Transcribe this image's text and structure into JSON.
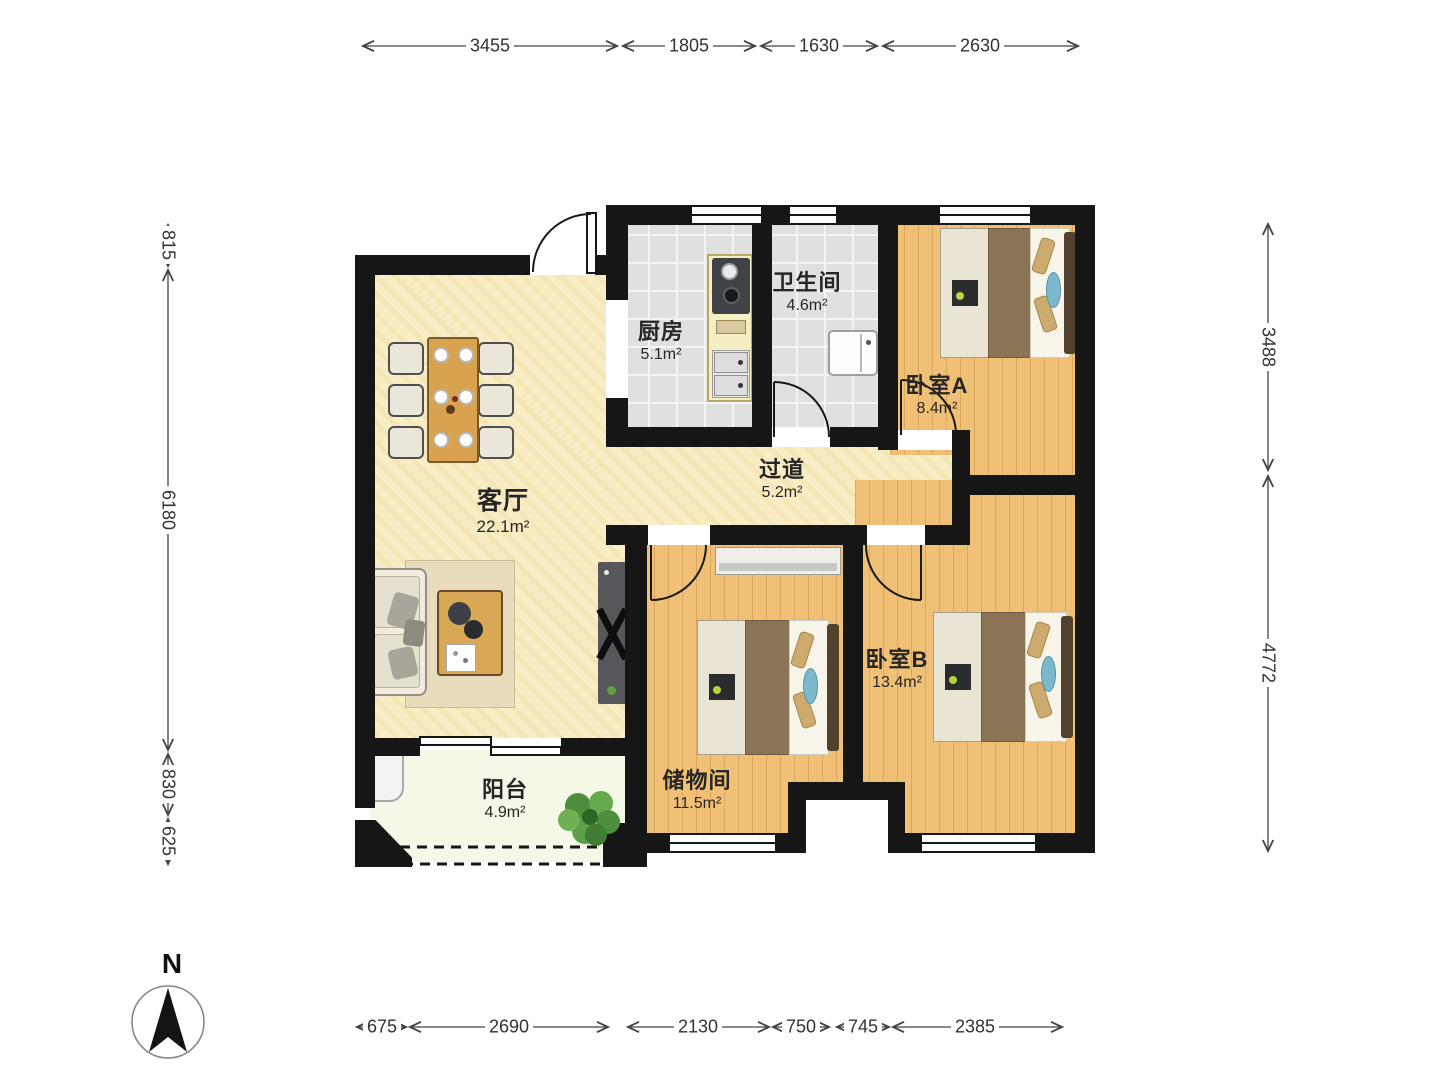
{
  "title": "apartment-floor-plan",
  "compass": {
    "label": "N"
  },
  "palette": {
    "wall": "#161616",
    "cream_floor": "#f8edc5",
    "wood_floor": "#f1c077",
    "tile_floor": "#e0e0e0",
    "balcony_floor": "#f6f8e7",
    "bed_blanket": "#8b7356",
    "pillow_tan": "#cdab6e",
    "accent_blue": "#7cb9cd",
    "plant_green": "#5ea04a"
  },
  "rooms": [
    {
      "id": "living_room",
      "name": "客厅",
      "area": "22.1m²"
    },
    {
      "id": "kitchen",
      "name": "厨房",
      "area": "5.1m²"
    },
    {
      "id": "bathroom",
      "name": "卫生间",
      "area": "4.6m²"
    },
    {
      "id": "bedroom_a",
      "name": "卧室A",
      "area": "8.4m²"
    },
    {
      "id": "hallway",
      "name": "过道",
      "area": "5.2m²"
    },
    {
      "id": "storage",
      "name": "储物间",
      "area": "11.5m²"
    },
    {
      "id": "bedroom_b",
      "name": "卧室B",
      "area": "13.4m²"
    },
    {
      "id": "balcony",
      "name": "阳台",
      "area": "4.9m²"
    }
  ],
  "dimensions": {
    "top": [
      "3455",
      "1805",
      "1630",
      "2630"
    ],
    "left": [
      "815",
      "6180",
      "830",
      "625"
    ],
    "right": [
      "3488",
      "4772"
    ],
    "bottom": [
      "675",
      "2690",
      "2130",
      "750",
      "745",
      "2385"
    ]
  }
}
